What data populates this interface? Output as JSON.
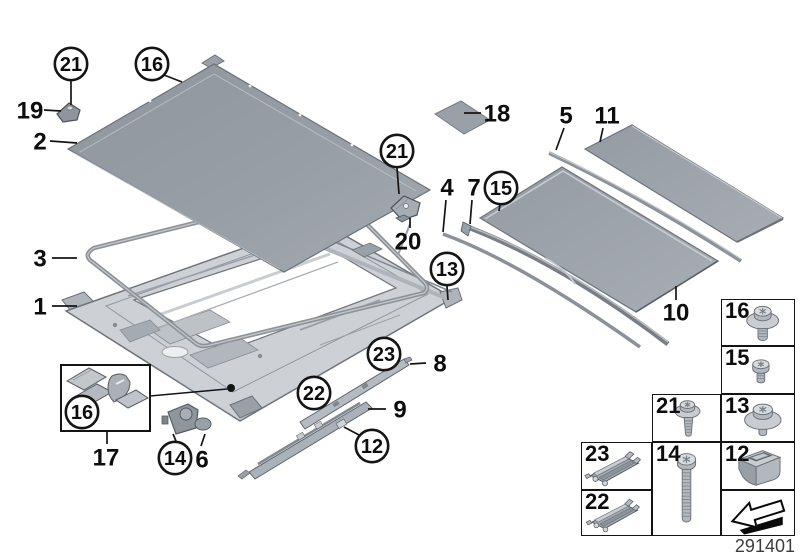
{
  "diagram": {
    "id_number": "291401",
    "colors": {
      "background": "#ffffff",
      "line": "#151515",
      "metal": "#9aa0a7",
      "metal_light": "#c9cdd2"
    },
    "callouts": [
      {
        "label": "21",
        "circled": true,
        "x": 71,
        "y": 64,
        "leader": [
          71,
          81,
          71,
          105
        ]
      },
      {
        "label": "16",
        "circled": true,
        "x": 152,
        "y": 64,
        "leader": [
          164,
          75,
          182,
          82
        ]
      },
      {
        "label": "19",
        "circled": false,
        "x": 30,
        "y": 110,
        "leader": [
          44,
          110,
          61,
          111
        ]
      },
      {
        "label": "2",
        "circled": false,
        "x": 40,
        "y": 141,
        "leader": [
          50,
          141,
          77,
          143
        ]
      },
      {
        "label": "3",
        "circled": false,
        "x": 40,
        "y": 258,
        "leader": [
          52,
          258,
          77,
          258
        ]
      },
      {
        "label": "1",
        "circled": false,
        "x": 40,
        "y": 306,
        "leader": [
          52,
          306,
          77,
          306
        ]
      },
      {
        "label": "18",
        "circled": false,
        "x": 497,
        "y": 113,
        "leader": [
          481,
          113,
          464,
          113
        ]
      },
      {
        "label": "5",
        "circled": false,
        "x": 566,
        "y": 115,
        "leader": [
          564,
          128,
          556,
          150
        ]
      },
      {
        "label": "11",
        "circled": false,
        "x": 607,
        "y": 115,
        "leader": [
          603,
          128,
          600,
          142
        ]
      },
      {
        "label": "4",
        "circled": false,
        "x": 447,
        "y": 187,
        "leader": [
          446,
          200,
          443,
          232
        ]
      },
      {
        "label": "7",
        "circled": false,
        "x": 474,
        "y": 187,
        "leader": [
          472,
          200,
          470,
          224
        ]
      },
      {
        "label": "15",
        "circled": true,
        "x": 501,
        "y": 188,
        "leader": [
          500,
          205,
          499,
          211
        ]
      },
      {
        "label": "21",
        "circled": true,
        "x": 397,
        "y": 151,
        "leader": [
          397,
          168,
          399,
          194
        ]
      },
      {
        "label": "20",
        "circled": false,
        "x": 408,
        "y": 241,
        "leader": [
          410,
          228,
          410,
          218
        ]
      },
      {
        "label": "13",
        "circled": true,
        "x": 447,
        "y": 269,
        "leader": [
          447,
          286,
          448,
          300
        ]
      },
      {
        "label": "10",
        "circled": false,
        "x": 676,
        "y": 312,
        "leader": [
          676,
          300,
          676,
          286
        ]
      },
      {
        "label": "8",
        "circled": false,
        "x": 440,
        "y": 363,
        "leader": [
          426,
          363,
          410,
          364
        ]
      },
      {
        "label": "23",
        "circled": true,
        "x": 384,
        "y": 354,
        "leader": null
      },
      {
        "label": "22",
        "circled": true,
        "x": 314,
        "y": 393,
        "leader": null
      },
      {
        "label": "9",
        "circled": false,
        "x": 400,
        "y": 409,
        "leader": [
          386,
          409,
          368,
          409
        ]
      },
      {
        "label": "12",
        "circled": true,
        "x": 372,
        "y": 446,
        "leader": [
          359,
          435,
          344,
          427
        ]
      },
      {
        "label": "16",
        "circled": true,
        "x": 82,
        "y": 412,
        "leader": null
      },
      {
        "label": "17",
        "circled": false,
        "x": 106,
        "y": 457,
        "leader": [
          107,
          444,
          107,
          432
        ]
      },
      {
        "label": "14",
        "circled": true,
        "x": 175,
        "y": 458,
        "leader": [
          176,
          441,
          173,
          434
        ]
      },
      {
        "label": "6",
        "circled": false,
        "x": 202,
        "y": 459,
        "leader": [
          201,
          446,
          205,
          434
        ]
      }
    ],
    "legend": {
      "cells": [
        {
          "label": "16",
          "icon": "flange-screw",
          "x": 721,
          "y": 299,
          "w": 74,
          "h": 47
        },
        {
          "label": "15",
          "icon": "small-screw",
          "x": 721,
          "y": 346,
          "w": 74,
          "h": 48
        },
        {
          "label": "21",
          "icon": "long-flange-screw",
          "x": 652,
          "y": 394,
          "w": 69,
          "h": 48
        },
        {
          "label": "13",
          "icon": "washer-screw",
          "x": 721,
          "y": 394,
          "w": 74,
          "h": 48
        },
        {
          "label": "23",
          "icon": "slider-clip",
          "x": 581,
          "y": 442,
          "w": 71,
          "h": 48
        },
        {
          "label": "14",
          "icon": "long-screw",
          "x": 652,
          "y": 442,
          "w": 69,
          "h": 94
        },
        {
          "label": "12",
          "icon": "cage-nut",
          "x": 721,
          "y": 442,
          "w": 74,
          "h": 48
        },
        {
          "label": "22",
          "icon": "slider-clip",
          "x": 581,
          "y": 490,
          "w": 71,
          "h": 46
        },
        {
          "label": "",
          "icon": "direction-arrow",
          "x": 721,
          "y": 490,
          "w": 74,
          "h": 46
        }
      ]
    }
  }
}
